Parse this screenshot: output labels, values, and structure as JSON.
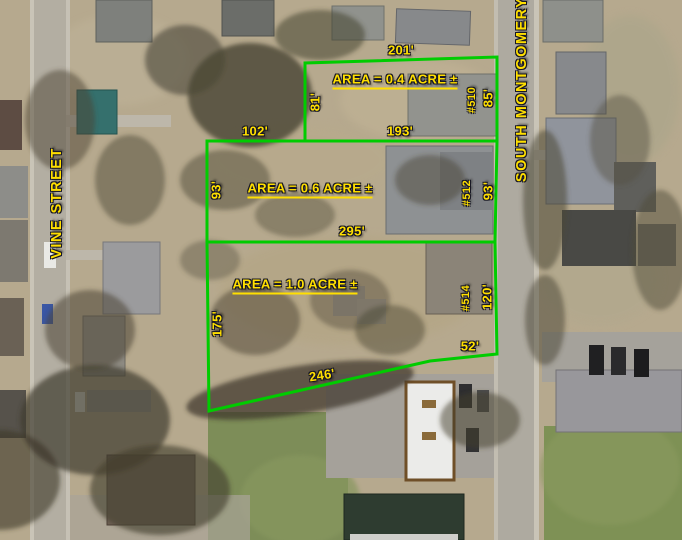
{
  "map": {
    "title": "Aerial parcel survey map",
    "colors": {
      "boundary": "#00cc00",
      "label": "#ffdf00"
    },
    "streets": [
      {
        "name": "VINE STREET"
      },
      {
        "name": "SOUTH MONTGOMERY ST"
      }
    ],
    "parcels": [
      {
        "area_label": "AREA = 0.4 ACRE ±",
        "house_number": "#510",
        "dimensions": {
          "top": "201'",
          "left": "81'",
          "right": "85'",
          "bottom": "193'"
        }
      },
      {
        "area_label": "AREA = 0.6 ACRE ±",
        "house_number": "#512",
        "dimensions": {
          "top": "102'",
          "left": "93'",
          "right": "93'",
          "bottom": "295'"
        }
      },
      {
        "area_label": "AREA = 1.0 ACRE ±",
        "house_number": "#514",
        "dimensions": {
          "left": "175'",
          "right": "120'",
          "step": "52'",
          "bottom": "246'"
        }
      }
    ]
  }
}
